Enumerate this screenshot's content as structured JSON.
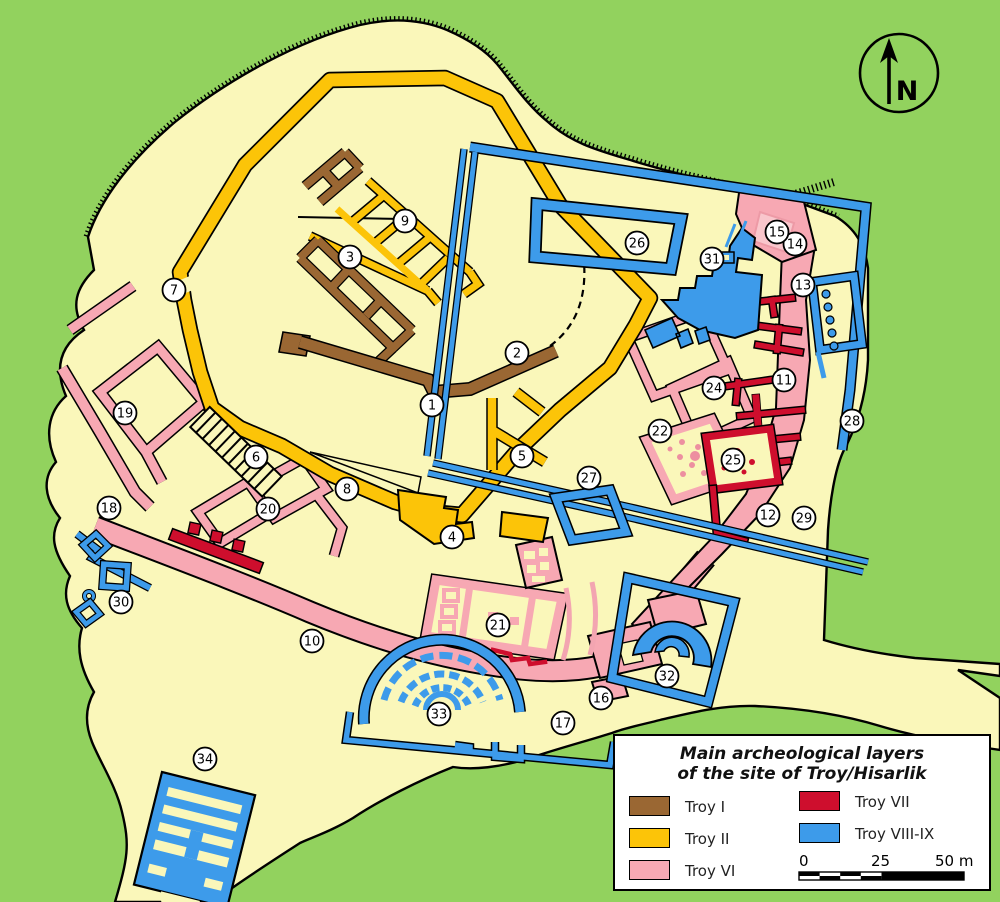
{
  "map_title": "Plan of the archaeological site of Troy / Hisarlik",
  "compass": {
    "label": "N"
  },
  "legend": {
    "title_line1": "Main archeological layers",
    "title_line2": "of the site of Troy/Hisarlik",
    "entries": [
      {
        "label": "Troy I",
        "color": "#9A6733"
      },
      {
        "label": "Troy II",
        "color": "#FCC408"
      },
      {
        "label": "Troy VI",
        "color": "#F7A8B3"
      },
      {
        "label": "Troy VII",
        "color": "#CE0E2D"
      },
      {
        "label": "Troy VIII-IX",
        "color": "#3D9BEA"
      }
    ],
    "scale": {
      "tick0": "0",
      "tick25": "25",
      "tick50": "50 m"
    }
  },
  "colors": {
    "background_green": "#92D25E",
    "mound_cream": "#FAF7BA",
    "troy1_brown": "#9A6733",
    "troy2_gold": "#FCC408",
    "troy6_pink": "#F7A8B3",
    "troy7_red": "#CE0E2D",
    "troy89_blue": "#3D9BEA"
  },
  "markers": [
    {
      "n": "1",
      "x": 432,
      "y": 405
    },
    {
      "n": "2",
      "x": 517,
      "y": 353
    },
    {
      "n": "3",
      "x": 350,
      "y": 257
    },
    {
      "n": "4",
      "x": 452,
      "y": 537
    },
    {
      "n": "5",
      "x": 522,
      "y": 456
    },
    {
      "n": "6",
      "x": 256,
      "y": 457
    },
    {
      "n": "7",
      "x": 174,
      "y": 290
    },
    {
      "n": "8",
      "x": 347,
      "y": 489
    },
    {
      "n": "9",
      "x": 405,
      "y": 221
    },
    {
      "n": "10",
      "x": 312,
      "y": 641
    },
    {
      "n": "11",
      "x": 784,
      "y": 380
    },
    {
      "n": "12",
      "x": 768,
      "y": 515
    },
    {
      "n": "13",
      "x": 803,
      "y": 285
    },
    {
      "n": "14",
      "x": 795,
      "y": 244
    },
    {
      "n": "15",
      "x": 777,
      "y": 232
    },
    {
      "n": "16",
      "x": 601,
      "y": 698
    },
    {
      "n": "17",
      "x": 563,
      "y": 723
    },
    {
      "n": "18",
      "x": 109,
      "y": 508
    },
    {
      "n": "19",
      "x": 125,
      "y": 413
    },
    {
      "n": "20",
      "x": 268,
      "y": 509
    },
    {
      "n": "21",
      "x": 498,
      "y": 625
    },
    {
      "n": "22",
      "x": 660,
      "y": 431
    },
    {
      "n": "24",
      "x": 714,
      "y": 388
    },
    {
      "n": "25",
      "x": 733,
      "y": 460
    },
    {
      "n": "26",
      "x": 637,
      "y": 243
    },
    {
      "n": "27",
      "x": 589,
      "y": 478
    },
    {
      "n": "28",
      "x": 852,
      "y": 421
    },
    {
      "n": "29",
      "x": 804,
      "y": 518
    },
    {
      "n": "30",
      "x": 121,
      "y": 602
    },
    {
      "n": "31",
      "x": 712,
      "y": 259
    },
    {
      "n": "32",
      "x": 667,
      "y": 676
    },
    {
      "n": "33",
      "x": 439,
      "y": 714
    },
    {
      "n": "34",
      "x": 205,
      "y": 759
    }
  ]
}
